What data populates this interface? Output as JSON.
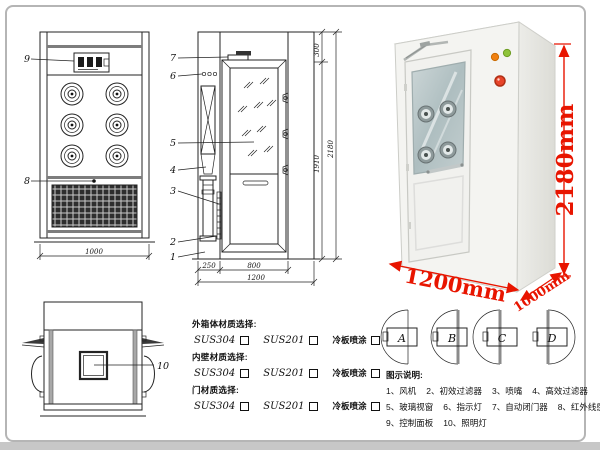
{
  "front_view": {
    "callout_9": "9",
    "callout_8": "8",
    "width_dim": "1000"
  },
  "side_view": {
    "callouts": [
      "7",
      "6",
      "5",
      "4",
      "3",
      "2",
      "1"
    ],
    "dims": {
      "top": "300",
      "door_height": "1910",
      "total_height": "2180",
      "left_depth": "250",
      "door_width": "800",
      "total_width": "1200"
    }
  },
  "top_view": {
    "callout_10": "10"
  },
  "photo": {
    "height_label": "2180mm",
    "width_label": "1200mm",
    "depth_label": "1000mm",
    "dim_color": "#e81500",
    "indicator_colors": {
      "orange": "#f08010",
      "green": "#8fc43a",
      "red_button": "#e8442a"
    }
  },
  "door_options": {
    "labels": [
      "A",
      "B",
      "C",
      "D"
    ]
  },
  "materials": {
    "sections": [
      {
        "title": "外箱体材质选择:",
        "options": [
          "SUS304",
          "SUS201",
          "冷板喷涂"
        ]
      },
      {
        "title": "内壁材质选择:",
        "options": [
          "SUS304",
          "SUS201",
          "冷板喷涂"
        ]
      },
      {
        "title": "门材质选择:",
        "options": [
          "SUS304",
          "SUS201",
          "冷板喷涂"
        ]
      }
    ]
  },
  "legend": {
    "title": "图示说明:",
    "rows": [
      [
        "1、风机",
        "2、初效过滤器",
        "3、喷嘴",
        "4、高效过滤器"
      ],
      [
        "5、玻璃视窗",
        "6、指示灯",
        "7、自动闭门器",
        "8、红外线感应器"
      ],
      [
        "9、控制面板",
        "10、照明灯"
      ]
    ]
  }
}
